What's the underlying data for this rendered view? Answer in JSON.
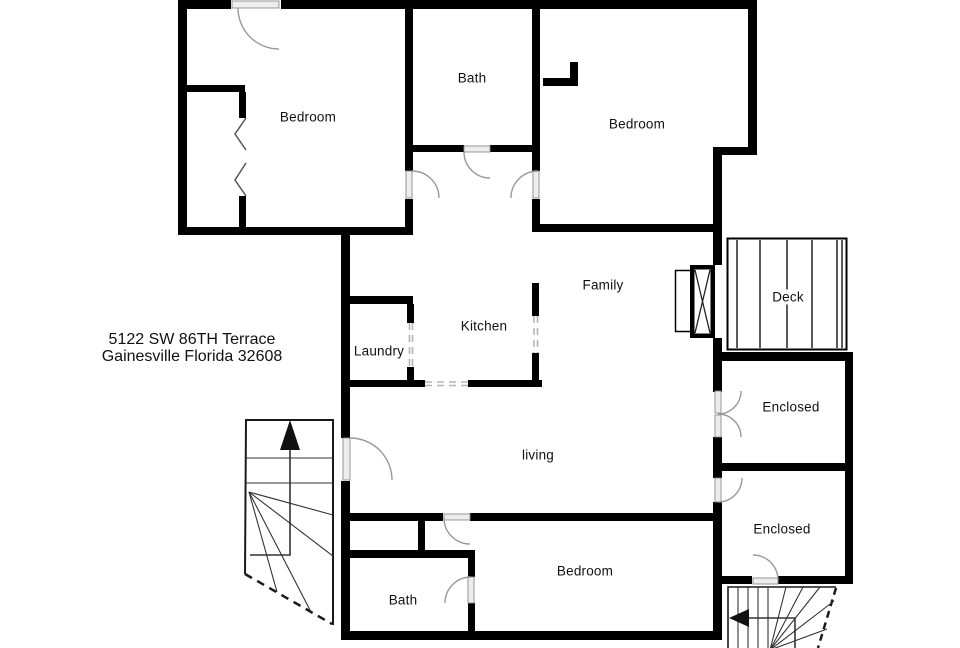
{
  "title": "Floor plan",
  "address": {
    "line1": "5122 SW 86TH Terrace",
    "line2": "Gainesville Florida 32608"
  },
  "rooms": [
    {
      "id": "bedroom-top-left",
      "label": "Bedroom"
    },
    {
      "id": "bath-top",
      "label": "Bath"
    },
    {
      "id": "bedroom-top-right",
      "label": "Bedroom"
    },
    {
      "id": "family",
      "label": "Family"
    },
    {
      "id": "kitchen",
      "label": "Kitchen"
    },
    {
      "id": "laundry",
      "label": "Laundry"
    },
    {
      "id": "deck",
      "label": "Deck"
    },
    {
      "id": "enclosed-upper",
      "label": "Enclosed"
    },
    {
      "id": "enclosed-lower",
      "label": "Enclosed"
    },
    {
      "id": "living",
      "label": "living"
    },
    {
      "id": "bedroom-bottom",
      "label": "Bedroom"
    },
    {
      "id": "bath-bottom",
      "label": "Bath"
    }
  ],
  "icons": [
    "stairs-up-arrow-icon",
    "stairs-left-arrow-icon",
    "fireplace-icon",
    "bifold-closet-door-icon"
  ],
  "colors": {
    "wall": "#000000",
    "door_arc": "#999999",
    "door_leaf": "#ededed",
    "dashed_opening": "#b5b5b5",
    "stair_line": "#333333",
    "text": "#111111",
    "background": "#ffffff"
  }
}
